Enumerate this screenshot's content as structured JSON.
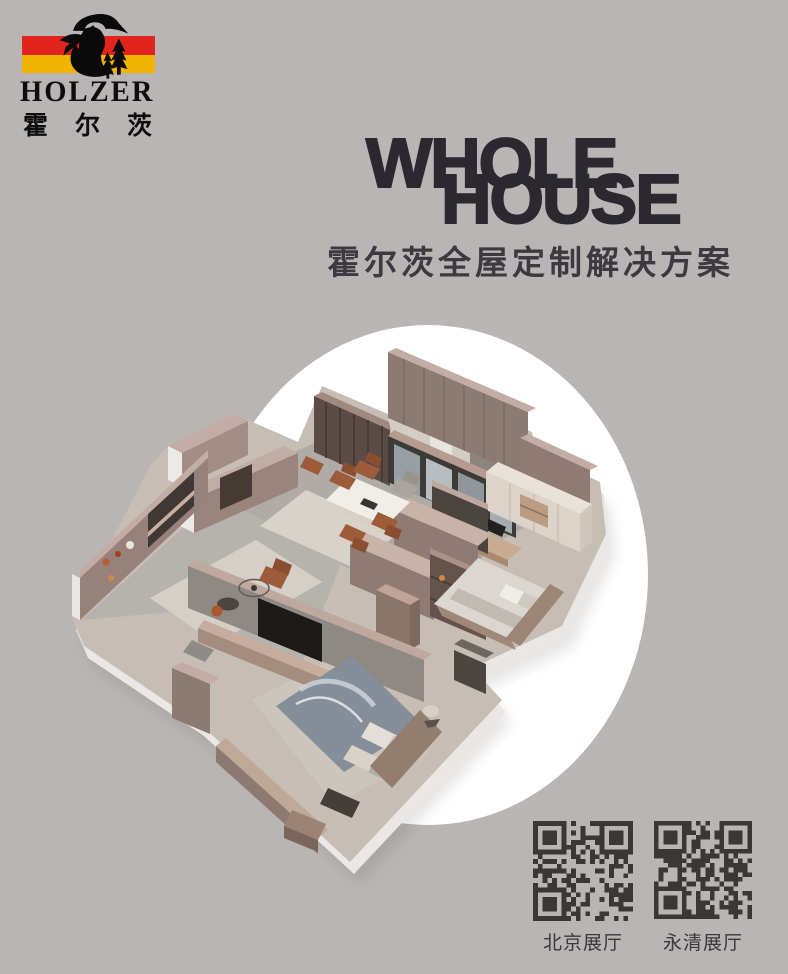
{
  "page": {
    "background_color": "#b9b5b4"
  },
  "logo": {
    "brand": "HOLZER",
    "brand_cn": "霍尔茨",
    "figure_icon": "lumberjack-axe-pines-icon",
    "stripe_red": "#e2251c",
    "stripe_yellow": "#f0b400"
  },
  "headline": {
    "line1": "WHOLE",
    "line2": "HOUSE",
    "subtitle": "霍尔茨全屋定制解决方案",
    "color": "#2b2830"
  },
  "hero": {
    "illustration": "isometric-apartment-floorplan-render",
    "circle_color": "#ffffff"
  },
  "qr_section": {
    "module_color": "#3a3736",
    "items": [
      {
        "label": "北京展厅"
      },
      {
        "label": "永清展厅"
      }
    ]
  }
}
